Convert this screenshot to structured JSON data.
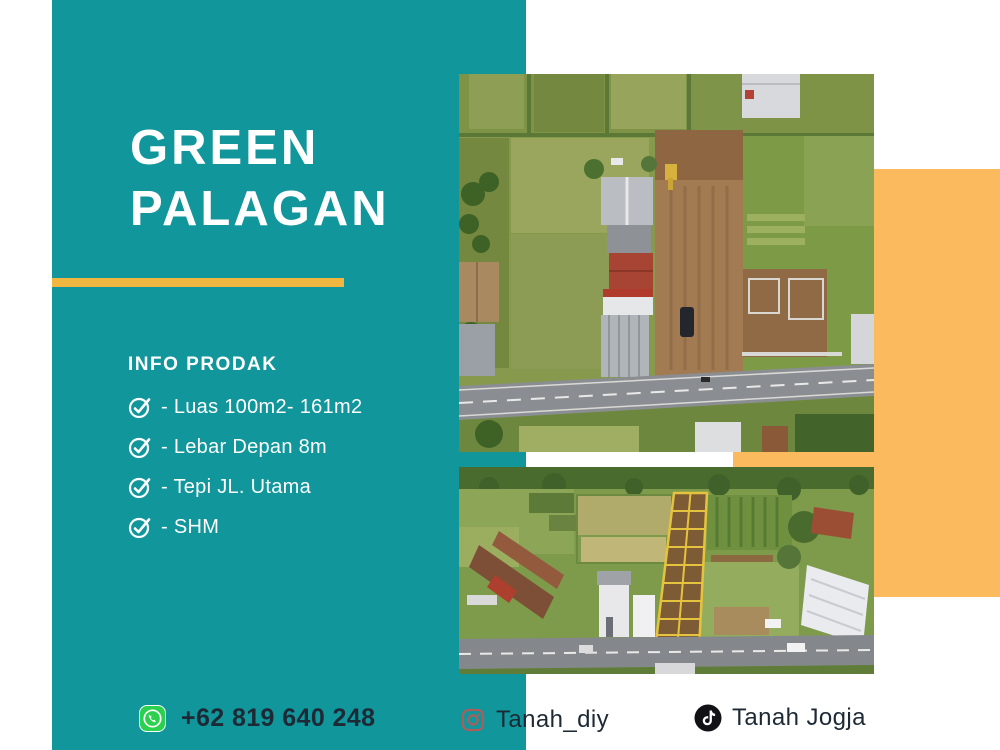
{
  "brand": {
    "title_line1": "GREEN",
    "title_line2": "PALAGAN"
  },
  "info": {
    "heading": "INFO PRODAK",
    "items": [
      "- Luas 100m2- 161m2",
      "- Lebar Depan 8m",
      "- Tepi JL. Utama",
      "- SHM"
    ]
  },
  "footer": {
    "whatsapp_number": "+62 819 640 248",
    "instagram_handle": "Tanah_diy",
    "tiktok_handle": "Tanah Jogja"
  },
  "icons": {
    "list_bullet": "circled-checkmark",
    "whatsapp": "whatsapp-phone-badge",
    "instagram": "instagram-camera-outline",
    "tiktok": "tiktok-music-note"
  },
  "colors": {
    "teal_panel": "#10969b",
    "orange_panel": "#fbba5e",
    "title_underline": "#f0b63f",
    "title_text": "#ffffff",
    "info_text": "#ffffff",
    "footer_text": "#1d2935",
    "whatsapp_green": "#2bd04e",
    "instagram_icon": "#a85f5e",
    "tiktok_icon": "#111116"
  },
  "photos": {
    "top_alt": "drone aerial view of cleared brown land lot beside houses and a main asphalt road",
    "bottom_alt": "drone aerial view of green fields with subdivided land plots outlined in yellow next to a road"
  }
}
